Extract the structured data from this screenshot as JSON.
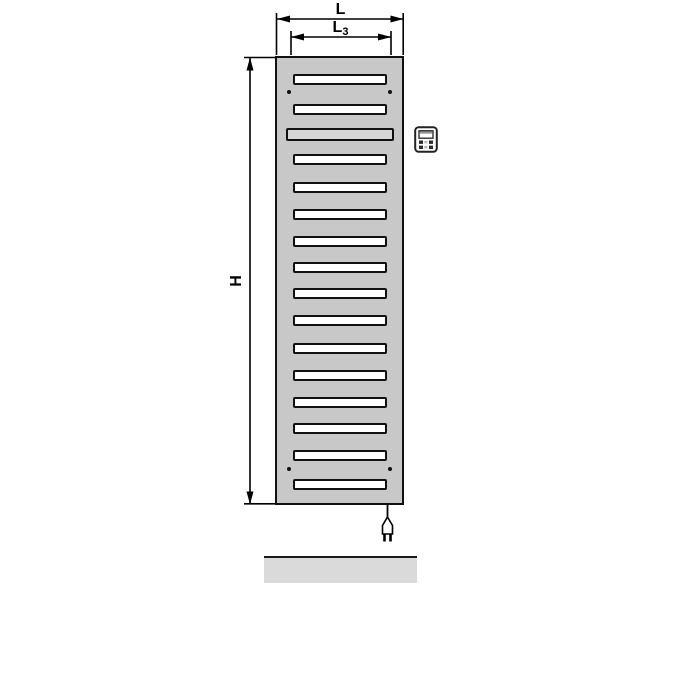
{
  "dimension_labels": {
    "width": {
      "text": "L"
    },
    "inner_width": {
      "text": "L",
      "subscript": "3"
    },
    "height": {
      "text": "H"
    }
  },
  "radiator": {
    "slot_count": 16,
    "slots": [
      {
        "top": 16,
        "type": "normal"
      },
      {
        "top": 46,
        "type": "normal"
      },
      {
        "top": 70,
        "type": "wide"
      },
      {
        "top": 96,
        "type": "normal"
      },
      {
        "top": 124,
        "type": "normal"
      },
      {
        "top": 151,
        "type": "normal"
      },
      {
        "top": 178,
        "type": "normal"
      },
      {
        "top": 204,
        "type": "normal"
      },
      {
        "top": 230,
        "type": "normal"
      },
      {
        "top": 257,
        "type": "normal"
      },
      {
        "top": 285,
        "type": "normal"
      },
      {
        "top": 312,
        "type": "normal"
      },
      {
        "top": 339,
        "type": "normal"
      },
      {
        "top": 365,
        "type": "normal"
      },
      {
        "top": 392,
        "type": "normal"
      },
      {
        "top": 421,
        "type": "normal"
      }
    ],
    "mounting_holes": [
      {
        "left": 10,
        "top": 32
      },
      {
        "left": 111,
        "top": 32
      },
      {
        "left": 10,
        "top": 409
      },
      {
        "left": 111,
        "top": 409
      }
    ],
    "colors": {
      "body": "#c8c8c8",
      "slot_fill": "#ffffff",
      "wide_slot_fill": "#d6d6d6",
      "outline": "#111111",
      "floor": "#dadada"
    }
  },
  "icons": {
    "controller": "heating-controller-icon",
    "plug": "power-plug-icon"
  }
}
